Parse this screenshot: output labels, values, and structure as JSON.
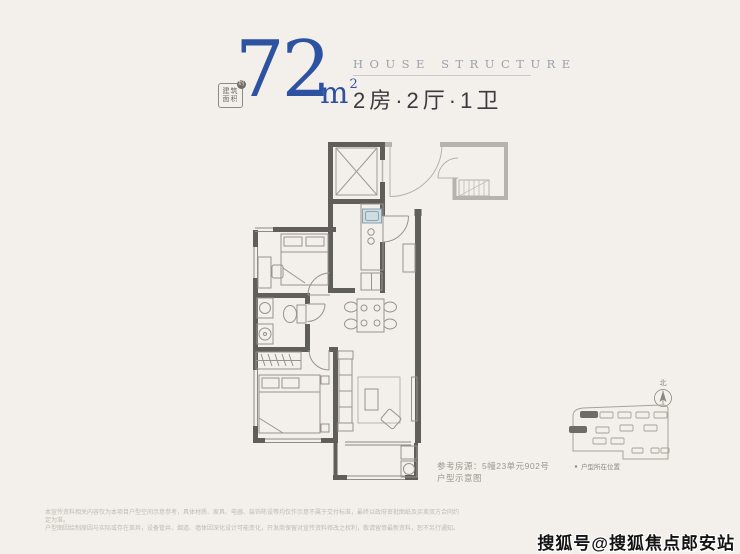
{
  "header": {
    "badge": {
      "line1": "建筑",
      "line2": "面积",
      "mark": "约"
    },
    "area": {
      "value": "72",
      "unit": "m",
      "sup": "2"
    },
    "subtitle_en": "HOUSE STRUCTURE",
    "rooms": "2房·2厅·1卫"
  },
  "floorplan": {
    "reference_label": "参考房源：5幢23单元902号",
    "reference_note": "户型示意图"
  },
  "siteplan": {
    "compass": "北",
    "legend": "户型所在位置"
  },
  "disclaimer": {
    "line1": "本宣传资料相关内容仅为本项目户型空间示意参考，具体材质、家具、电器、装饰陈设等均仅作示意不属于交付标准，最终以政府审批图纸及买卖双方合同约定为准。",
    "line2": "户型图因绘制原因与实际或存在差异，设备管井、烟道、墙体因深化设计可能变化，开发商保留对宣传资料修改之权利，敬请留意最新资料，恕不另行通知。"
  },
  "watermark": "搜狐号@搜狐焦点郎安站",
  "colors": {
    "background": "#f3efea",
    "accent_blue": "#2d52a2",
    "wall_dark": "#5f5e5b",
    "wall_light": "#b7b2ac",
    "sink_blue": "#cddde1",
    "highlight_building": "#6f6b66"
  }
}
